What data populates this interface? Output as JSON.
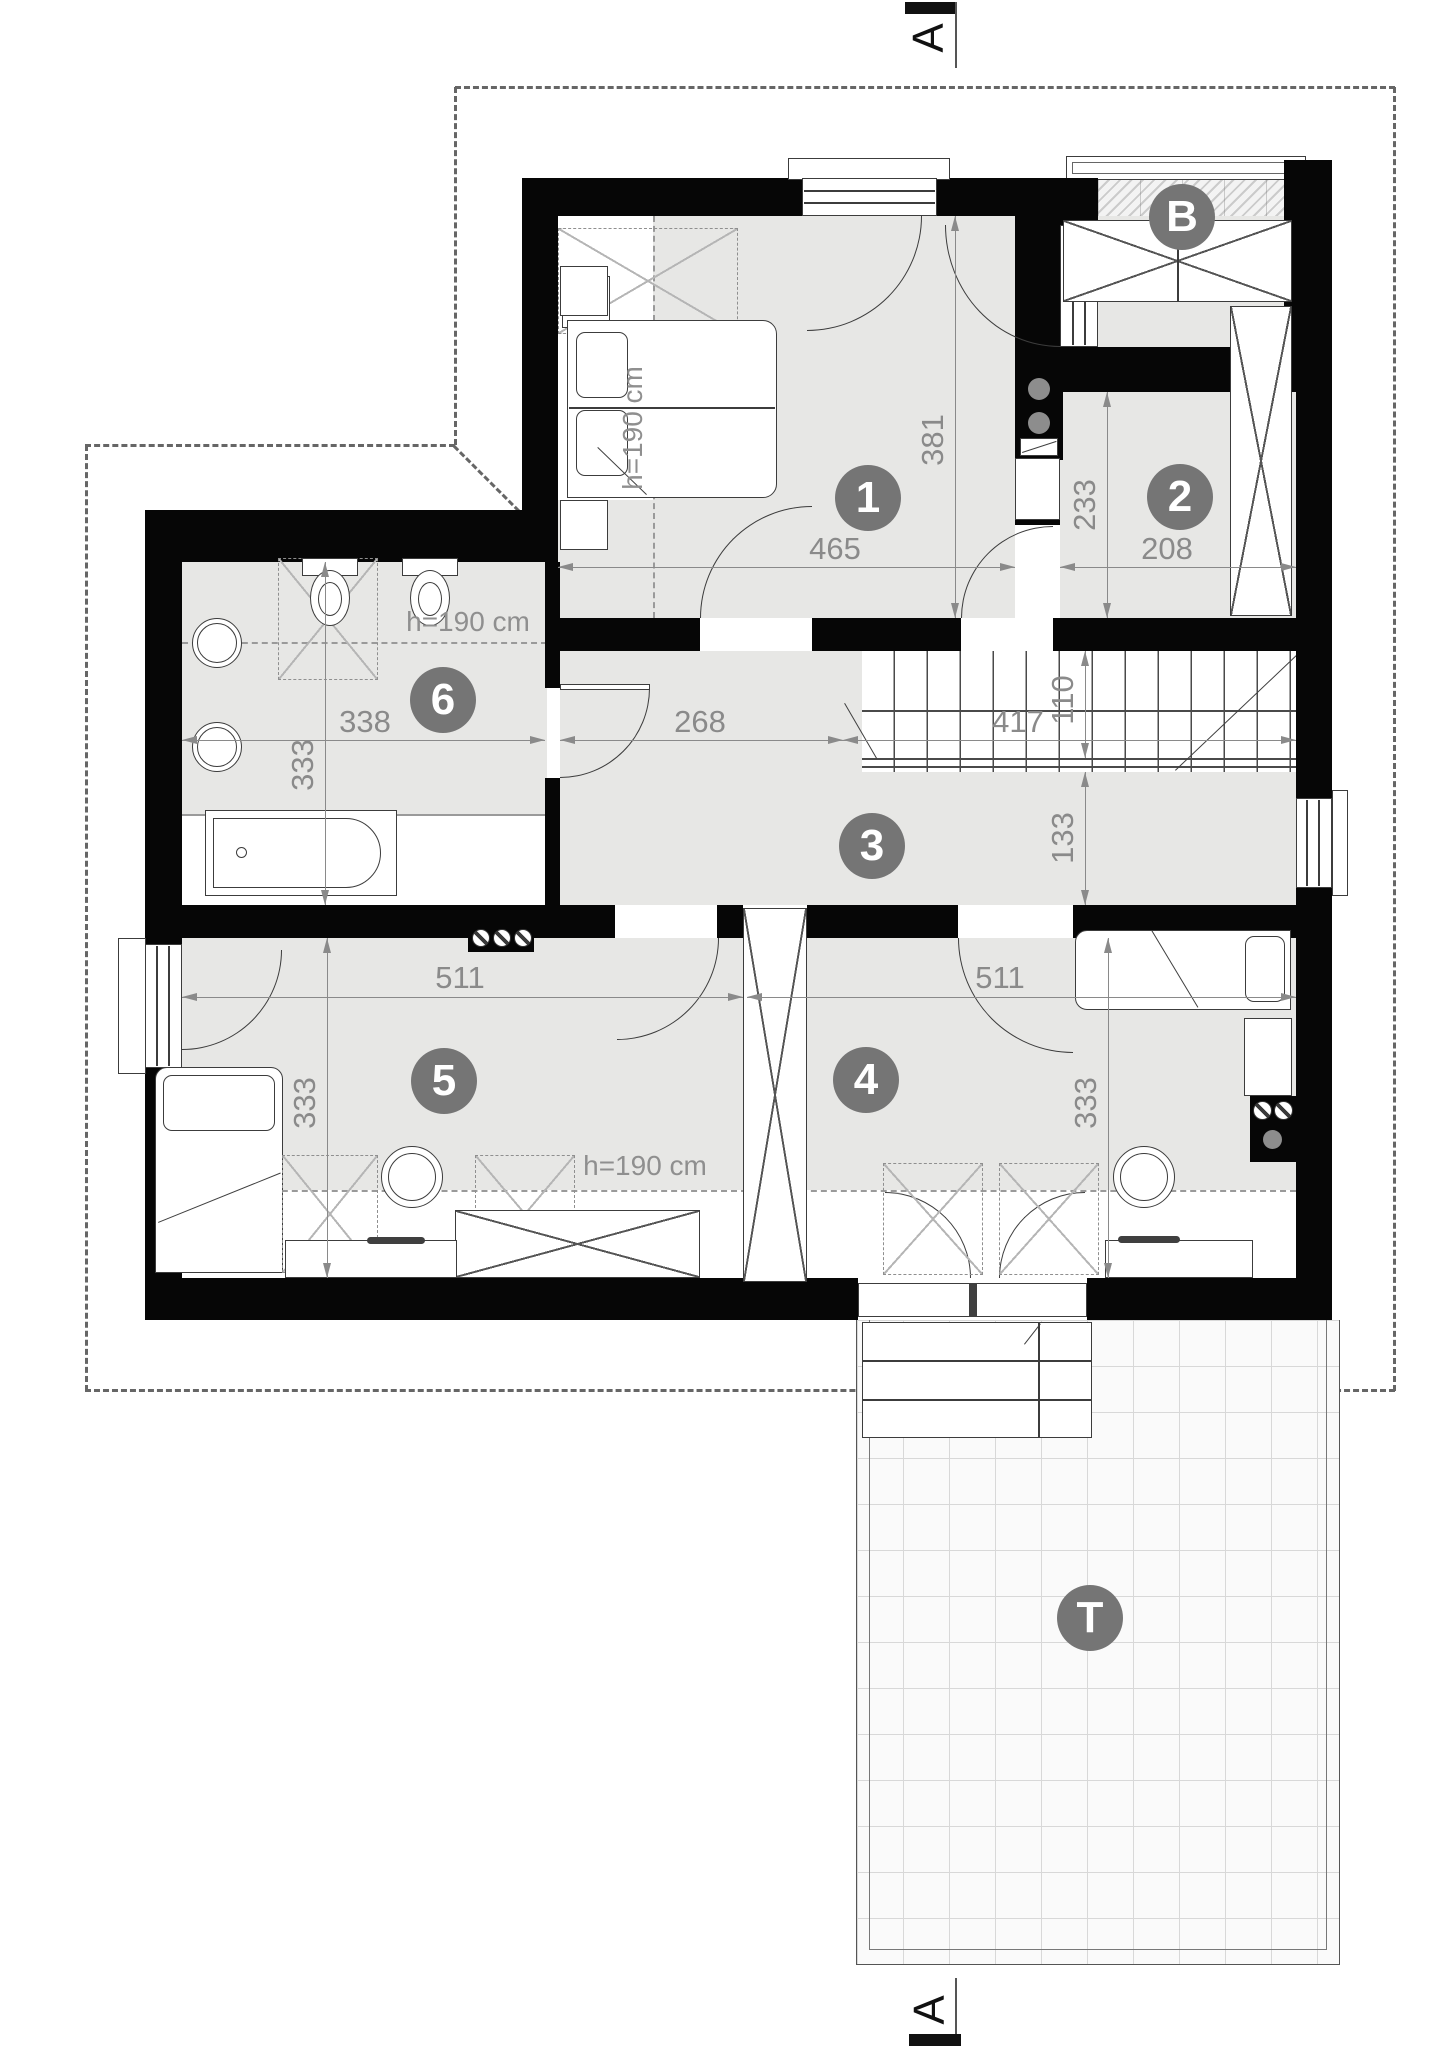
{
  "drawing": {
    "type": "attic-floor-plan",
    "section_marker": "A",
    "rooms": {
      "r1": "1",
      "r2": "2",
      "r3": "3",
      "r4": "4",
      "r5": "5",
      "r6": "6",
      "balcony": "B",
      "terrace": "T"
    },
    "height_labels": {
      "room1": "h=190 cm",
      "bathroom": "h=190 cm",
      "rooms45": "h=190 cm"
    },
    "dimensions": {
      "room1_depth": "381",
      "room1_width": "465",
      "room2_depth": "233",
      "room2_width": "208",
      "hall_width": "268",
      "stairs_length": "417",
      "stairs_width": "110",
      "stairs_to_wall": "133",
      "bathroom_width": "338",
      "bathroom_depth": "333",
      "room5_width": "511",
      "room5_depth": "333",
      "room4_width": "511",
      "room4_depth": "333"
    },
    "colors": {
      "wall": "#060606",
      "floor": "#e7e7e5",
      "dimension": "#8a8a8a",
      "badge": "#757575"
    }
  }
}
